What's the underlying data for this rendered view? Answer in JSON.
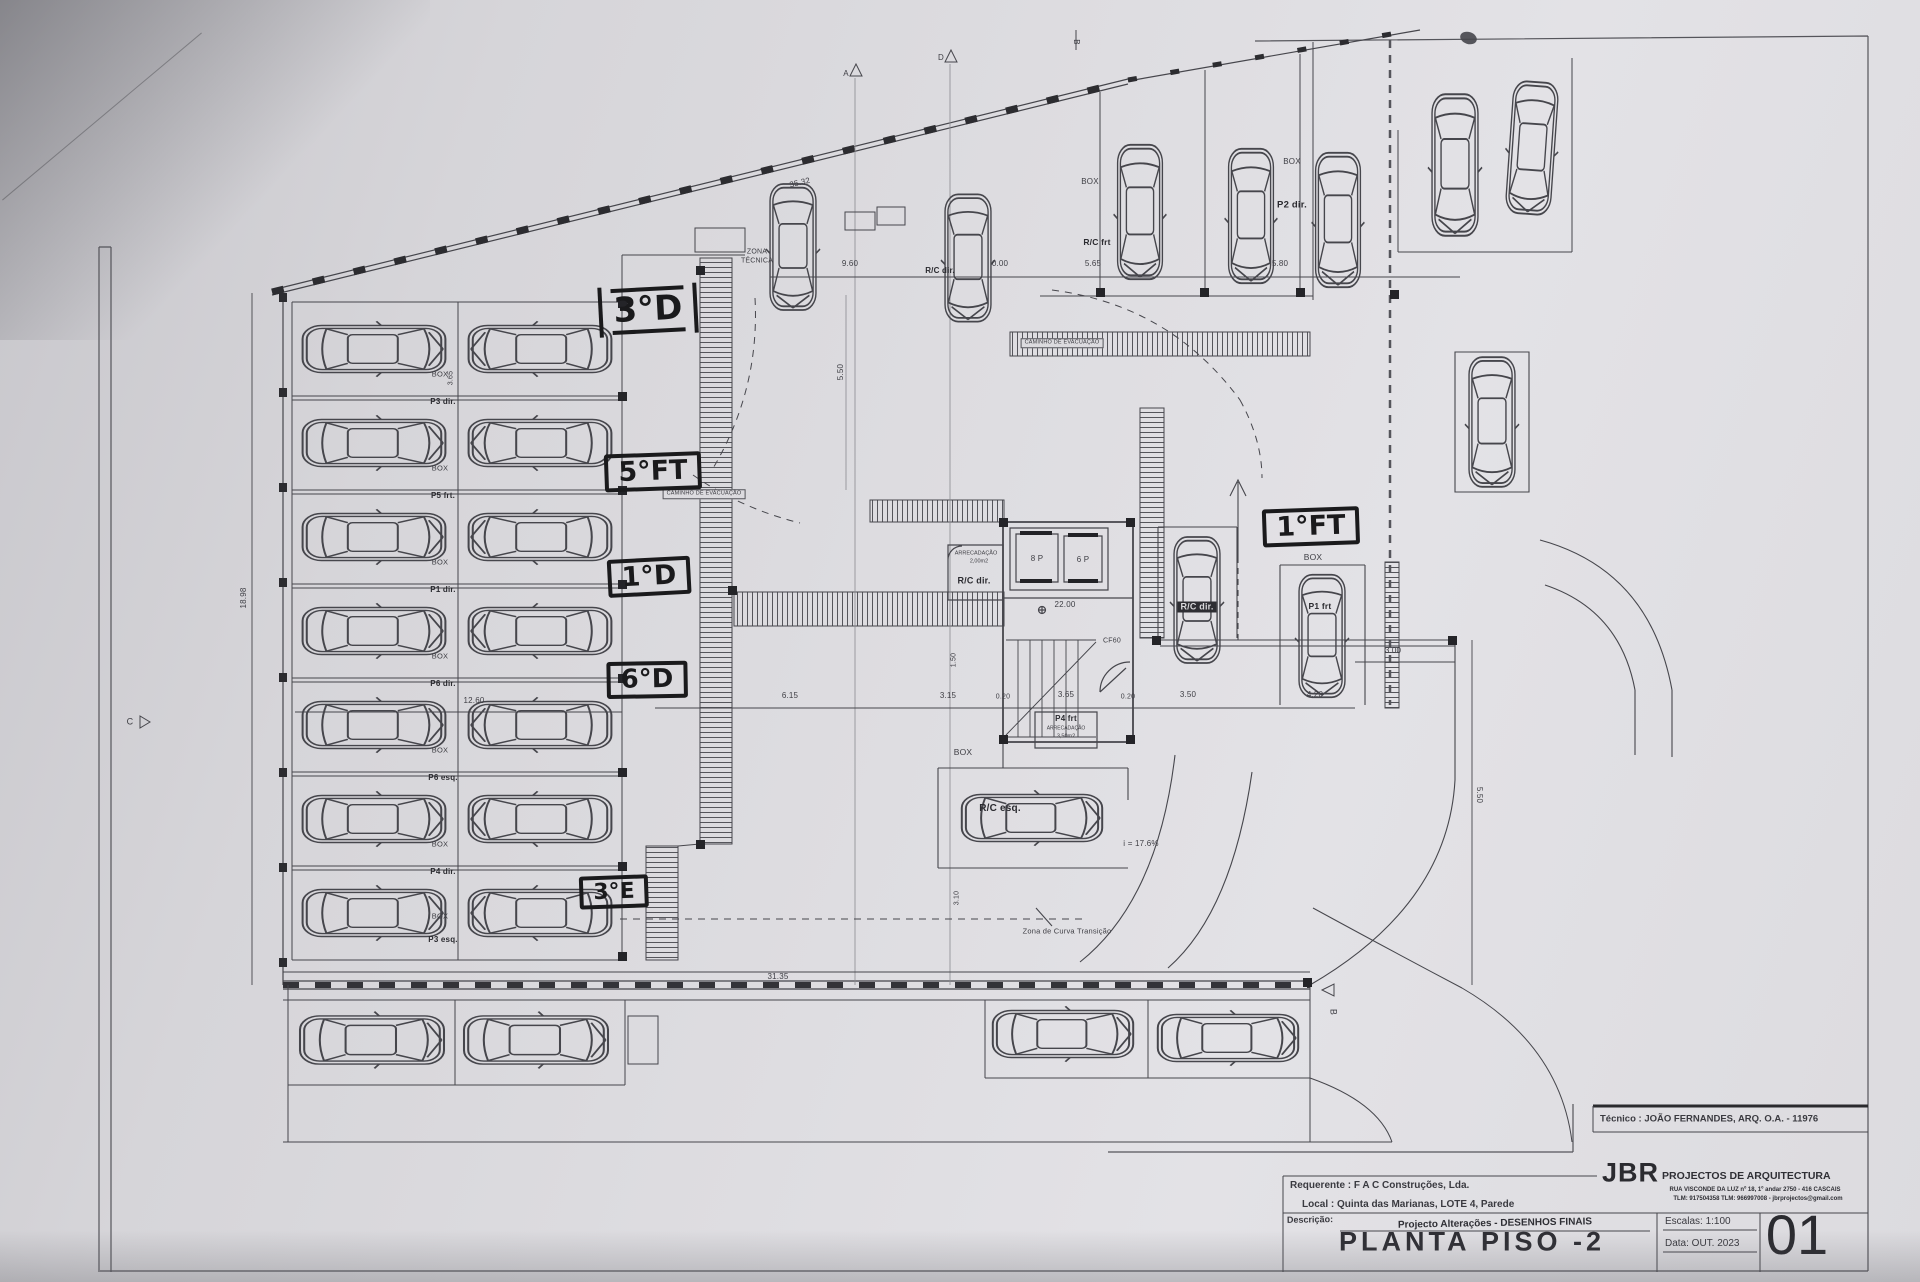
{
  "sheet": {
    "title": "PLANTA PISO -2",
    "number": "01",
    "escalas": "Escalas:  1:100",
    "data": "Data: OUT.  2023",
    "tecnico": "Técnico : JOÃO FERNANDES, ARQ.   O.A. - 11976",
    "requerente": "Requerente : F A C  Construções, Lda.",
    "local": "Local : Quinta das Marianas, LOTE 4, Parede",
    "descricao_label": "Descrição:",
    "descricao": "Projecto Alterações - DESENHOS FINAIS",
    "logo": "JBR",
    "logo_sub": "PROJECTOS DE ARQUITECTURA",
    "addr1": "RUA VISCONDE DA LUZ nº 18, 1º andar  2750 - 416  CASCAIS",
    "addr2": "TLM: 917504358  TLM: 966997008 - jbrprojectos@gmail.com"
  },
  "annotations": {
    "a3d": "3°D",
    "a5ft": "5°FT",
    "a1d": "1°D",
    "a6d": "6°D",
    "a3e": "3°E",
    "a1ft": "1°FT"
  },
  "labels": {
    "box": "BOX",
    "zona": "ZONA",
    "tecnica": "TÉCNICA",
    "caminho": "CAMINHO DE EVACUAÇÃO",
    "arrecadacao": "ARRECADAÇÃO",
    "area_200": "2,00m2",
    "area_350": "3,50m2",
    "lift8": "8 P",
    "lift6": "6 P",
    "cf60": "CF60",
    "nivel": "22.00",
    "rampa": "i = 17.6%",
    "curva": "Zona de Curva Transição",
    "rc_dir": "R/C dir.",
    "rc_esq": "R/C esq.",
    "rc_frt": "R/C frt",
    "p1_frt": "P1 frt",
    "p2_dir": "P2 dir.",
    "p4_frt": "P4 frt"
  },
  "left_rows": [
    "P3 dir.",
    "P5 frt.",
    "P1 dir.",
    "P6 dir.",
    "P6 esq.",
    "P4 dir.",
    "P3 esq."
  ],
  "dims": {
    "top": "35.32",
    "left": "18.98",
    "bottom": "31.35",
    "d960": "9.60",
    "d000": "0.00",
    "d565": "5.65",
    "d580": "5.80",
    "d1260": "12.60",
    "d615": "6.15",
    "d315": "3.15",
    "d020a": "0.20",
    "d365": "3.65",
    "d020b": "0.20",
    "d350": "3.50",
    "d420": "4.20",
    "d300": "3.00",
    "d550": "5.50",
    "d550b": "5.50",
    "d150": "1.50",
    "d310": "3.10"
  },
  "markers": {
    "a": "A",
    "b": "B",
    "c": "C",
    "d": "D"
  }
}
